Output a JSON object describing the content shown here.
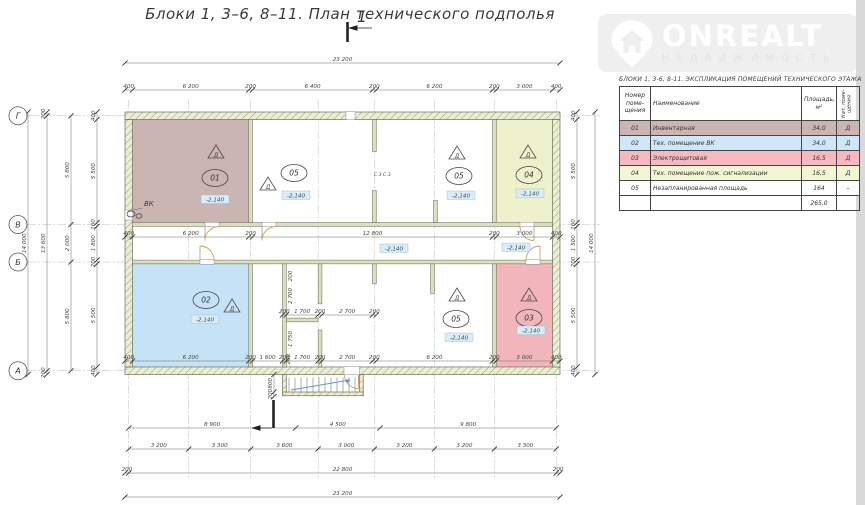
{
  "title": "Блоки 1,  3–6, 8–11.    План технического подполья",
  "watermark": {
    "brand": "ONREALT",
    "subtitle": "НЕДВИЖИМОСТЬ",
    "box_color": "#efefef",
    "text_color": "#ffffff"
  },
  "table": {
    "title": "БЛОКИ 1,  3-6, 8-11.  ЭКСПЛИКАЦИЯ ПОМЕЩЕНИЙ ТЕХНИЧЕСКОГО ЭТАЖА",
    "headers": {
      "num": "Номер\nпоме-\nщения",
      "name": "Наименование",
      "area": "Площадь,\nм²",
      "cat": "Кат. поме-\nщения"
    },
    "rows": [
      {
        "num": "01",
        "name": "Инвентарная",
        "area": "34,0",
        "cat": "Д",
        "color": "#cbb5b2"
      },
      {
        "num": "02",
        "name": "Тех. помещение ВК",
        "area": "34,0",
        "cat": "Д",
        "color": "#cfe6f8"
      },
      {
        "num": "03",
        "name": "Электрощитовая",
        "area": "16,5",
        "cat": "Д",
        "color": "#f6b9bf"
      },
      {
        "num": "04",
        "name": "Тех. помещение пож. сигнализации",
        "area": "16,5",
        "cat": "Д",
        "color": "#f2f6d2"
      },
      {
        "num": "05",
        "name": "Незапланированная площадь",
        "area": "164",
        "cat": "–",
        "color": "#ffffff"
      }
    ],
    "total_label": "",
    "total": "265,0"
  },
  "plan": {
    "colors": {
      "room01": "#cbb5b2",
      "room02": "#c6e2f6",
      "room03": "#f3b5bc",
      "room04": "#edf2cc",
      "wall_hatch": "#98a45e",
      "wall_bg": "#ebeed6",
      "door": "#cf9d66",
      "stair_arrow": "#5b8fd4",
      "elev_bg": "#d9ecf7"
    },
    "rooms": [
      {
        "name": "room-01-inventory",
        "x": 132.5,
        "y": 119.5,
        "w": 116.25,
        "h": 103.1,
        "fill": "#cbb5b2"
      },
      {
        "name": "room-04-fire-alarm",
        "x": 496.25,
        "y": 119.5,
        "w": 56.25,
        "h": 103.1,
        "fill": "#edf2cc"
      },
      {
        "name": "room-02-vk",
        "x": 132.5,
        "y": 263.85,
        "w": 116.25,
        "h": 103.1,
        "fill": "#c6e2f6"
      },
      {
        "name": "room-03-electrical",
        "x": 496.25,
        "y": 263.85,
        "w": 56.25,
        "h": 103.1,
        "fill": "#f3b5bc"
      }
    ],
    "walls": [
      {
        "x": 125,
        "y": 112,
        "w": 435,
        "h": 7.5
      },
      {
        "x": 125,
        "y": 366.95,
        "w": 435,
        "h": 7.5
      },
      {
        "x": 125,
        "y": 119.5,
        "w": 7.5,
        "h": 247.45
      },
      {
        "x": 552.5,
        "y": 119.5,
        "w": 7.5,
        "h": 247.45
      },
      {
        "x": 282.5,
        "y": 374.45,
        "w": 3.75,
        "h": 21
      },
      {
        "x": 359.5,
        "y": 374.45,
        "w": 3.75,
        "h": 21
      },
      {
        "x": 282.5,
        "y": 392,
        "w": 80.75,
        "h": 3.75
      }
    ],
    "partitions": [
      {
        "x": 248.75,
        "y": 119.5,
        "w": 3.75,
        "h": 103.1
      },
      {
        "x": 372.5,
        "y": 119.5,
        "w": 3.75,
        "h": 32
      },
      {
        "x": 372.5,
        "y": 190.6,
        "w": 3.75,
        "h": 32
      },
      {
        "x": 433.5,
        "y": 200.5,
        "w": 3.75,
        "h": 22
      },
      {
        "x": 492.5,
        "y": 119.5,
        "w": 3.75,
        "h": 103.1
      },
      {
        "x": 132.5,
        "y": 222.6,
        "w": 420,
        "h": 3.75
      },
      {
        "x": 132.5,
        "y": 260.1,
        "w": 420,
        "h": 3.75
      },
      {
        "x": 248.75,
        "y": 263.85,
        "w": 3.75,
        "h": 103.1
      },
      {
        "x": 282.5,
        "y": 263.85,
        "w": 3.75,
        "h": 103.1
      },
      {
        "x": 318.15,
        "y": 263.85,
        "w": 3.75,
        "h": 40
      },
      {
        "x": 318.15,
        "y": 330,
        "w": 3.75,
        "h": 37
      },
      {
        "x": 286.25,
        "y": 318.1,
        "w": 31.9,
        "h": 3.75
      },
      {
        "x": 372.5,
        "y": 263.85,
        "w": 3.75,
        "h": 20
      },
      {
        "x": 430.6,
        "y": 263.85,
        "w": 3.75,
        "h": 30
      },
      {
        "x": 492.5,
        "y": 263.85,
        "w": 3.75,
        "h": 103.1
      }
    ],
    "gaps": [
      {
        "x": 205,
        "y": 222.3,
        "w": 14,
        "h": 4.4
      },
      {
        "x": 262,
        "y": 222.3,
        "w": 14,
        "h": 4.4
      },
      {
        "x": 520,
        "y": 222.3,
        "w": 14,
        "h": 4.4
      },
      {
        "x": 200,
        "y": 259.8,
        "w": 14,
        "h": 4.4
      },
      {
        "x": 526,
        "y": 259.8,
        "w": 14,
        "h": 4.4
      },
      {
        "x": 344,
        "y": 366.7,
        "w": 15.5,
        "h": 8
      },
      {
        "x": 125,
        "y": 210,
        "w": 7.8,
        "h": 10
      },
      {
        "x": 346,
        "y": 111.8,
        "w": 9,
        "h": 8
      }
    ],
    "doors": [
      {
        "leaf": "M205,226.5 V240.5",
        "arc": "M205,240.5 A14,14 0 0 1 219,226.5"
      },
      {
        "leaf": "M262,226.5 V240.5",
        "arc": "M262,240.5 A14,14 0 0 1 276,226.5"
      },
      {
        "leaf": "M200,259.9 V246",
        "arc": "M200,246 A14,14 0 0 1 214,259.9"
      },
      {
        "leaf": "M534,226.5 V240.5",
        "arc": "M520,226.5 A14,14 0 0 0 534,240.5"
      },
      {
        "leaf": "M540,259.9 V246",
        "arc": "M540,246 A14,14 0 0 0 526,259.9"
      },
      {
        "leaf": "M358.5,374.5 V388.5",
        "arc": "M358.5,388.5 A14,14 0 0 1 344.5,374.5"
      }
    ],
    "axes": [
      {
        "label": "Г",
        "y": 115.75
      },
      {
        "label": "В",
        "y": 224.5
      },
      {
        "label": "Б",
        "y": 262
      },
      {
        "label": "А",
        "y": 370.75
      }
    ],
    "grid_x": [
      128.75,
      188.75,
      250.65,
      318.15,
      374.4,
      434.4,
      494.4,
      556.25
    ],
    "room_labels": [
      {
        "num": "01",
        "cat": "Д",
        "elev": "-2,140",
        "tri": [
          216,
          152
        ],
        "oval": [
          215,
          178
        ],
        "box": [
          215,
          200
        ]
      },
      {
        "num": "05",
        "cat": "Д",
        "elev": "-2,140",
        "tri": [
          268,
          184
        ],
        "oval": [
          294,
          173
        ],
        "box": [
          296,
          196
        ]
      },
      {
        "num": "05",
        "cat": "Д",
        "elev": "-2,140",
        "tri": [
          457,
          153
        ],
        "oval": [
          459,
          176
        ],
        "box": [
          461,
          196
        ]
      },
      {
        "num": "04",
        "cat": "Д",
        "elev": "-2,140",
        "tri": [
          528,
          152
        ],
        "oval": [
          529,
          175
        ],
        "box": [
          530,
          194
        ]
      },
      {
        "num": "02",
        "cat": "Д",
        "elev": "-2,140",
        "tri": [
          232,
          306
        ],
        "oval": [
          206,
          300
        ],
        "box": [
          205,
          320
        ]
      },
      {
        "num": "05",
        "cat": "Д",
        "elev": "-2,140",
        "tri": [
          457,
          295
        ],
        "oval": [
          456,
          319
        ],
        "box": [
          459,
          338
        ]
      },
      {
        "num": "03",
        "cat": "Д",
        "elev": "-2,140",
        "tri": [
          529,
          295
        ],
        "oval": [
          529,
          318
        ],
        "box": [
          531,
          331
        ]
      }
    ],
    "corridor_elevs": [
      {
        "t": "-2,140",
        "x": 394,
        "y": 249
      },
      {
        "t": "-2,140",
        "x": 516,
        "y": 248
      }
    ],
    "dim_chains": [
      {
        "o": "h",
        "pos": 63,
        "b": [
          125,
          560
        ],
        "l": [
          "23 200"
        ]
      },
      {
        "o": "h",
        "pos": 90,
        "b": [
          125,
          132.5,
          248.75,
          252.5,
          372.5,
          376.25,
          492.5,
          496.25,
          552.5,
          560
        ],
        "l": [
          "400",
          "6 200",
          "200",
          "6 400",
          "200",
          "6 200",
          "200",
          "3 000",
          "400"
        ]
      },
      {
        "o": "h",
        "pos": 237,
        "b": [
          125,
          132.5,
          248.75,
          252.5,
          492.5,
          496.25,
          552.5,
          560
        ],
        "l": [
          "400",
          "6 200",
          "200",
          "12 800",
          "200",
          "3 000",
          "400"
        ]
      },
      {
        "o": "h",
        "pos": 361,
        "b": [
          125,
          132.5,
          248.75,
          252.5,
          282.5,
          286.25,
          318.1,
          321.9,
          372.5,
          376.25,
          492.5,
          496.25,
          552.5,
          560
        ],
        "l": [
          "400",
          "6 200",
          "200",
          "1 600",
          "200",
          "1 700",
          "200",
          "2 700",
          "200",
          "6 200",
          "200",
          "3 000",
          "400"
        ]
      },
      {
        "o": "h",
        "pos": 315,
        "b": [
          282.5,
          286.25,
          318.1,
          321.9,
          372.5,
          376.25
        ],
        "l": [
          "200",
          "1 700",
          "200",
          "2 700",
          "200"
        ]
      },
      {
        "o": "h",
        "pos": 428,
        "b": [
          128.75,
          295.6,
          380,
          556.25
        ],
        "l": [
          "8 900",
          "4 500",
          "9 800"
        ]
      },
      {
        "o": "h",
        "pos": 449,
        "b": [
          128.75,
          188.75,
          250.65,
          318.15,
          374.4,
          434.4,
          494.4,
          556.25
        ],
        "l": [
          "3 200",
          "3 300",
          "3 600",
          "3 000",
          "3 200",
          "3 200",
          "3 300"
        ]
      },
      {
        "o": "h",
        "pos": 473,
        "b": [
          125,
          128.75,
          556.25,
          560
        ],
        "l": [
          "200",
          "22 800",
          "200"
        ]
      },
      {
        "o": "h",
        "pos": 497,
        "b": [
          125,
          560
        ],
        "l": [
          "23 200"
        ]
      },
      {
        "o": "v",
        "pos": 28,
        "b": [
          112,
          374.5
        ],
        "l": [
          "14 000"
        ]
      },
      {
        "o": "v",
        "pos": 47,
        "b": [
          112,
          115.75,
          370.75,
          374.5
        ],
        "l": [
          "200",
          "13 600",
          "200"
        ]
      },
      {
        "o": "v",
        "pos": 71,
        "b": [
          115.75,
          224.5,
          262,
          370.75
        ],
        "l": [
          "5 800",
          "2 000",
          "5 800"
        ]
      },
      {
        "o": "v",
        "pos": 97,
        "b": [
          112,
          119.5,
          222.6,
          226.35,
          260.1,
          263.85,
          366.95,
          374.45
        ],
        "l": [
          "400",
          "5 500",
          "200",
          "1 800",
          "200",
          "5 500",
          "400"
        ]
      },
      {
        "o": "v",
        "pos": 577,
        "b": [
          112,
          119.5,
          222.6,
          226.35,
          260.1,
          263.85,
          366.95,
          374.45
        ],
        "l": [
          "400",
          "5 500",
          "200",
          "1 500",
          "200",
          "5 500",
          "400"
        ]
      },
      {
        "o": "v",
        "pos": 595,
        "b": [
          112,
          374.5
        ],
        "l": [
          "14 000"
        ]
      },
      {
        "o": "v",
        "pos": 274,
        "b": [
          374.45,
          392,
          396.5
        ],
        "l": [
          "800",
          "200"
        ]
      }
    ],
    "extra_dim_labels": [
      {
        "t": "200",
        "x": 292,
        "y": 276,
        "rot": -90
      },
      {
        "t": "2 700",
        "x": 292,
        "y": 296,
        "rot": -90
      },
      {
        "t": "1 750",
        "x": 292,
        "y": 339,
        "rot": -90
      },
      {
        "t": "200",
        "x": 290,
        "y": 359,
        "rot": -90
      }
    ],
    "misc_labels": [
      {
        "t": "ВК",
        "x": 144,
        "y": 206,
        "s": 7
      },
      {
        "t": "С 3   С 3",
        "x": 374,
        "y": 176,
        "s": 4.6
      }
    ],
    "section_mark": {
      "label": "1"
    },
    "stairs": {
      "x0": 289,
      "x1": 355,
      "n": 12,
      "y0": 377.5,
      "y1": 391.5
    }
  }
}
